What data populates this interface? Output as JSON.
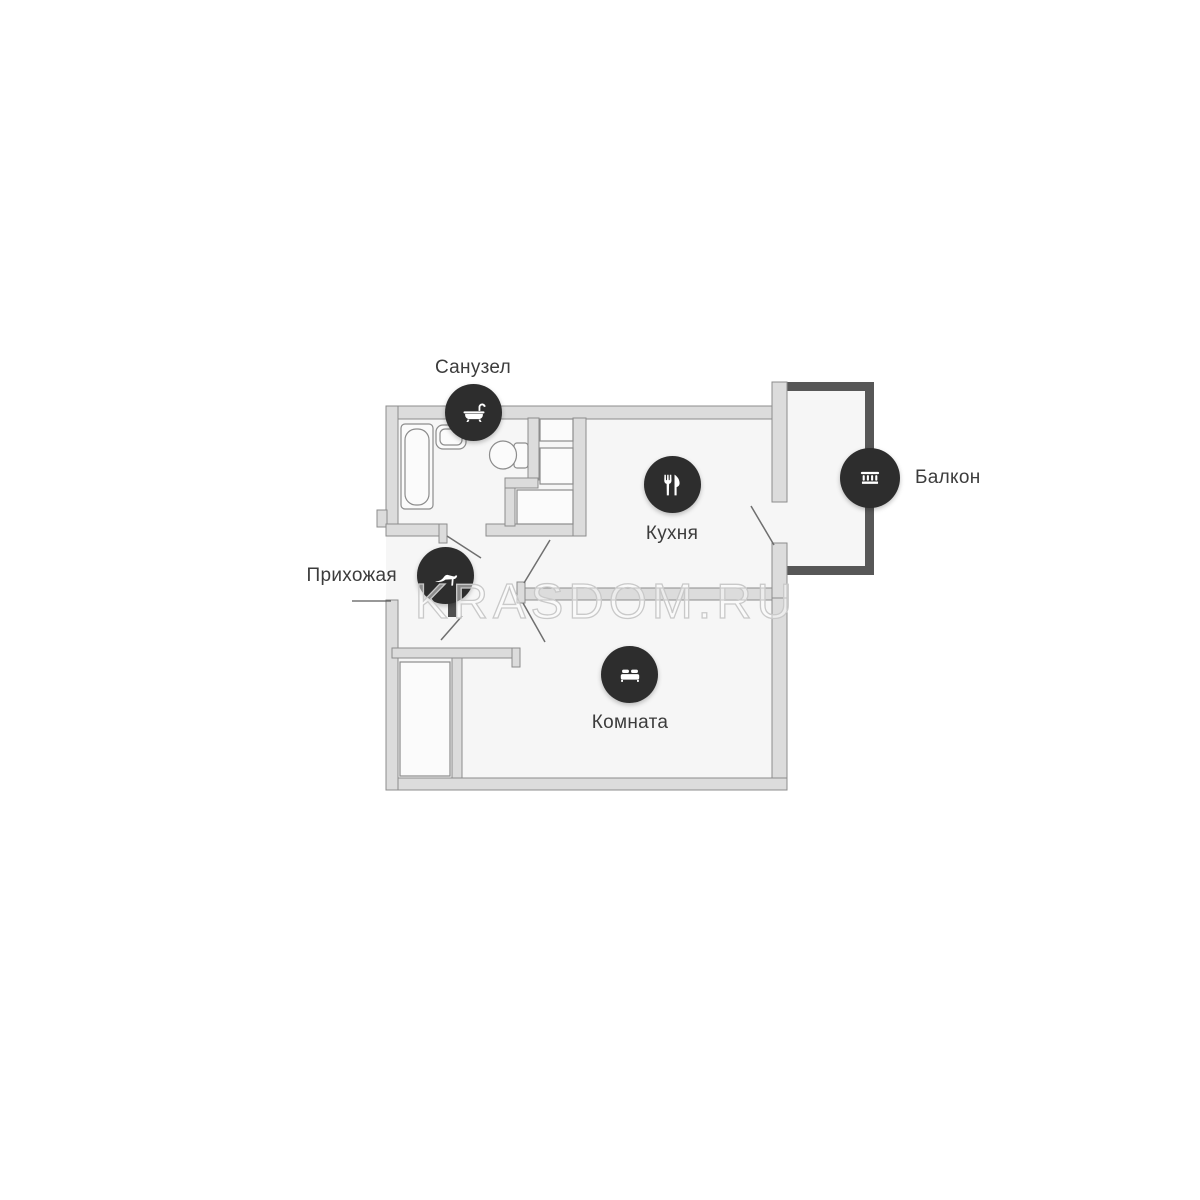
{
  "watermark": "KRASDOM.RU",
  "rooms": [
    {
      "id": "bathroom",
      "label": "Санузел",
      "icon": "bathtub-icon"
    },
    {
      "id": "hallway",
      "label": "Прихожая",
      "icon": "high-heel-shoe-icon"
    },
    {
      "id": "kitchen",
      "label": "Кухня",
      "icon": "fork-knife-icon"
    },
    {
      "id": "room",
      "label": "Комната",
      "icon": "bed-icon"
    },
    {
      "id": "balcony",
      "label": "Балкон",
      "icon": "balcony-railing-icon"
    }
  ],
  "colors": {
    "background": "#ffffff",
    "interior_fill": "#f6f6f6",
    "wall_fill": "#dcdcdc",
    "wall_stroke": "#8c8c8c",
    "balcony_wall_fill": "#575757",
    "icon_badge_fill": "#2d2d2d",
    "icon_glyph": "#ffffff",
    "label_text": "#3c3c3c",
    "watermark_outline": "#c9c9c9",
    "door_swing_line": "#6f6f6f"
  }
}
